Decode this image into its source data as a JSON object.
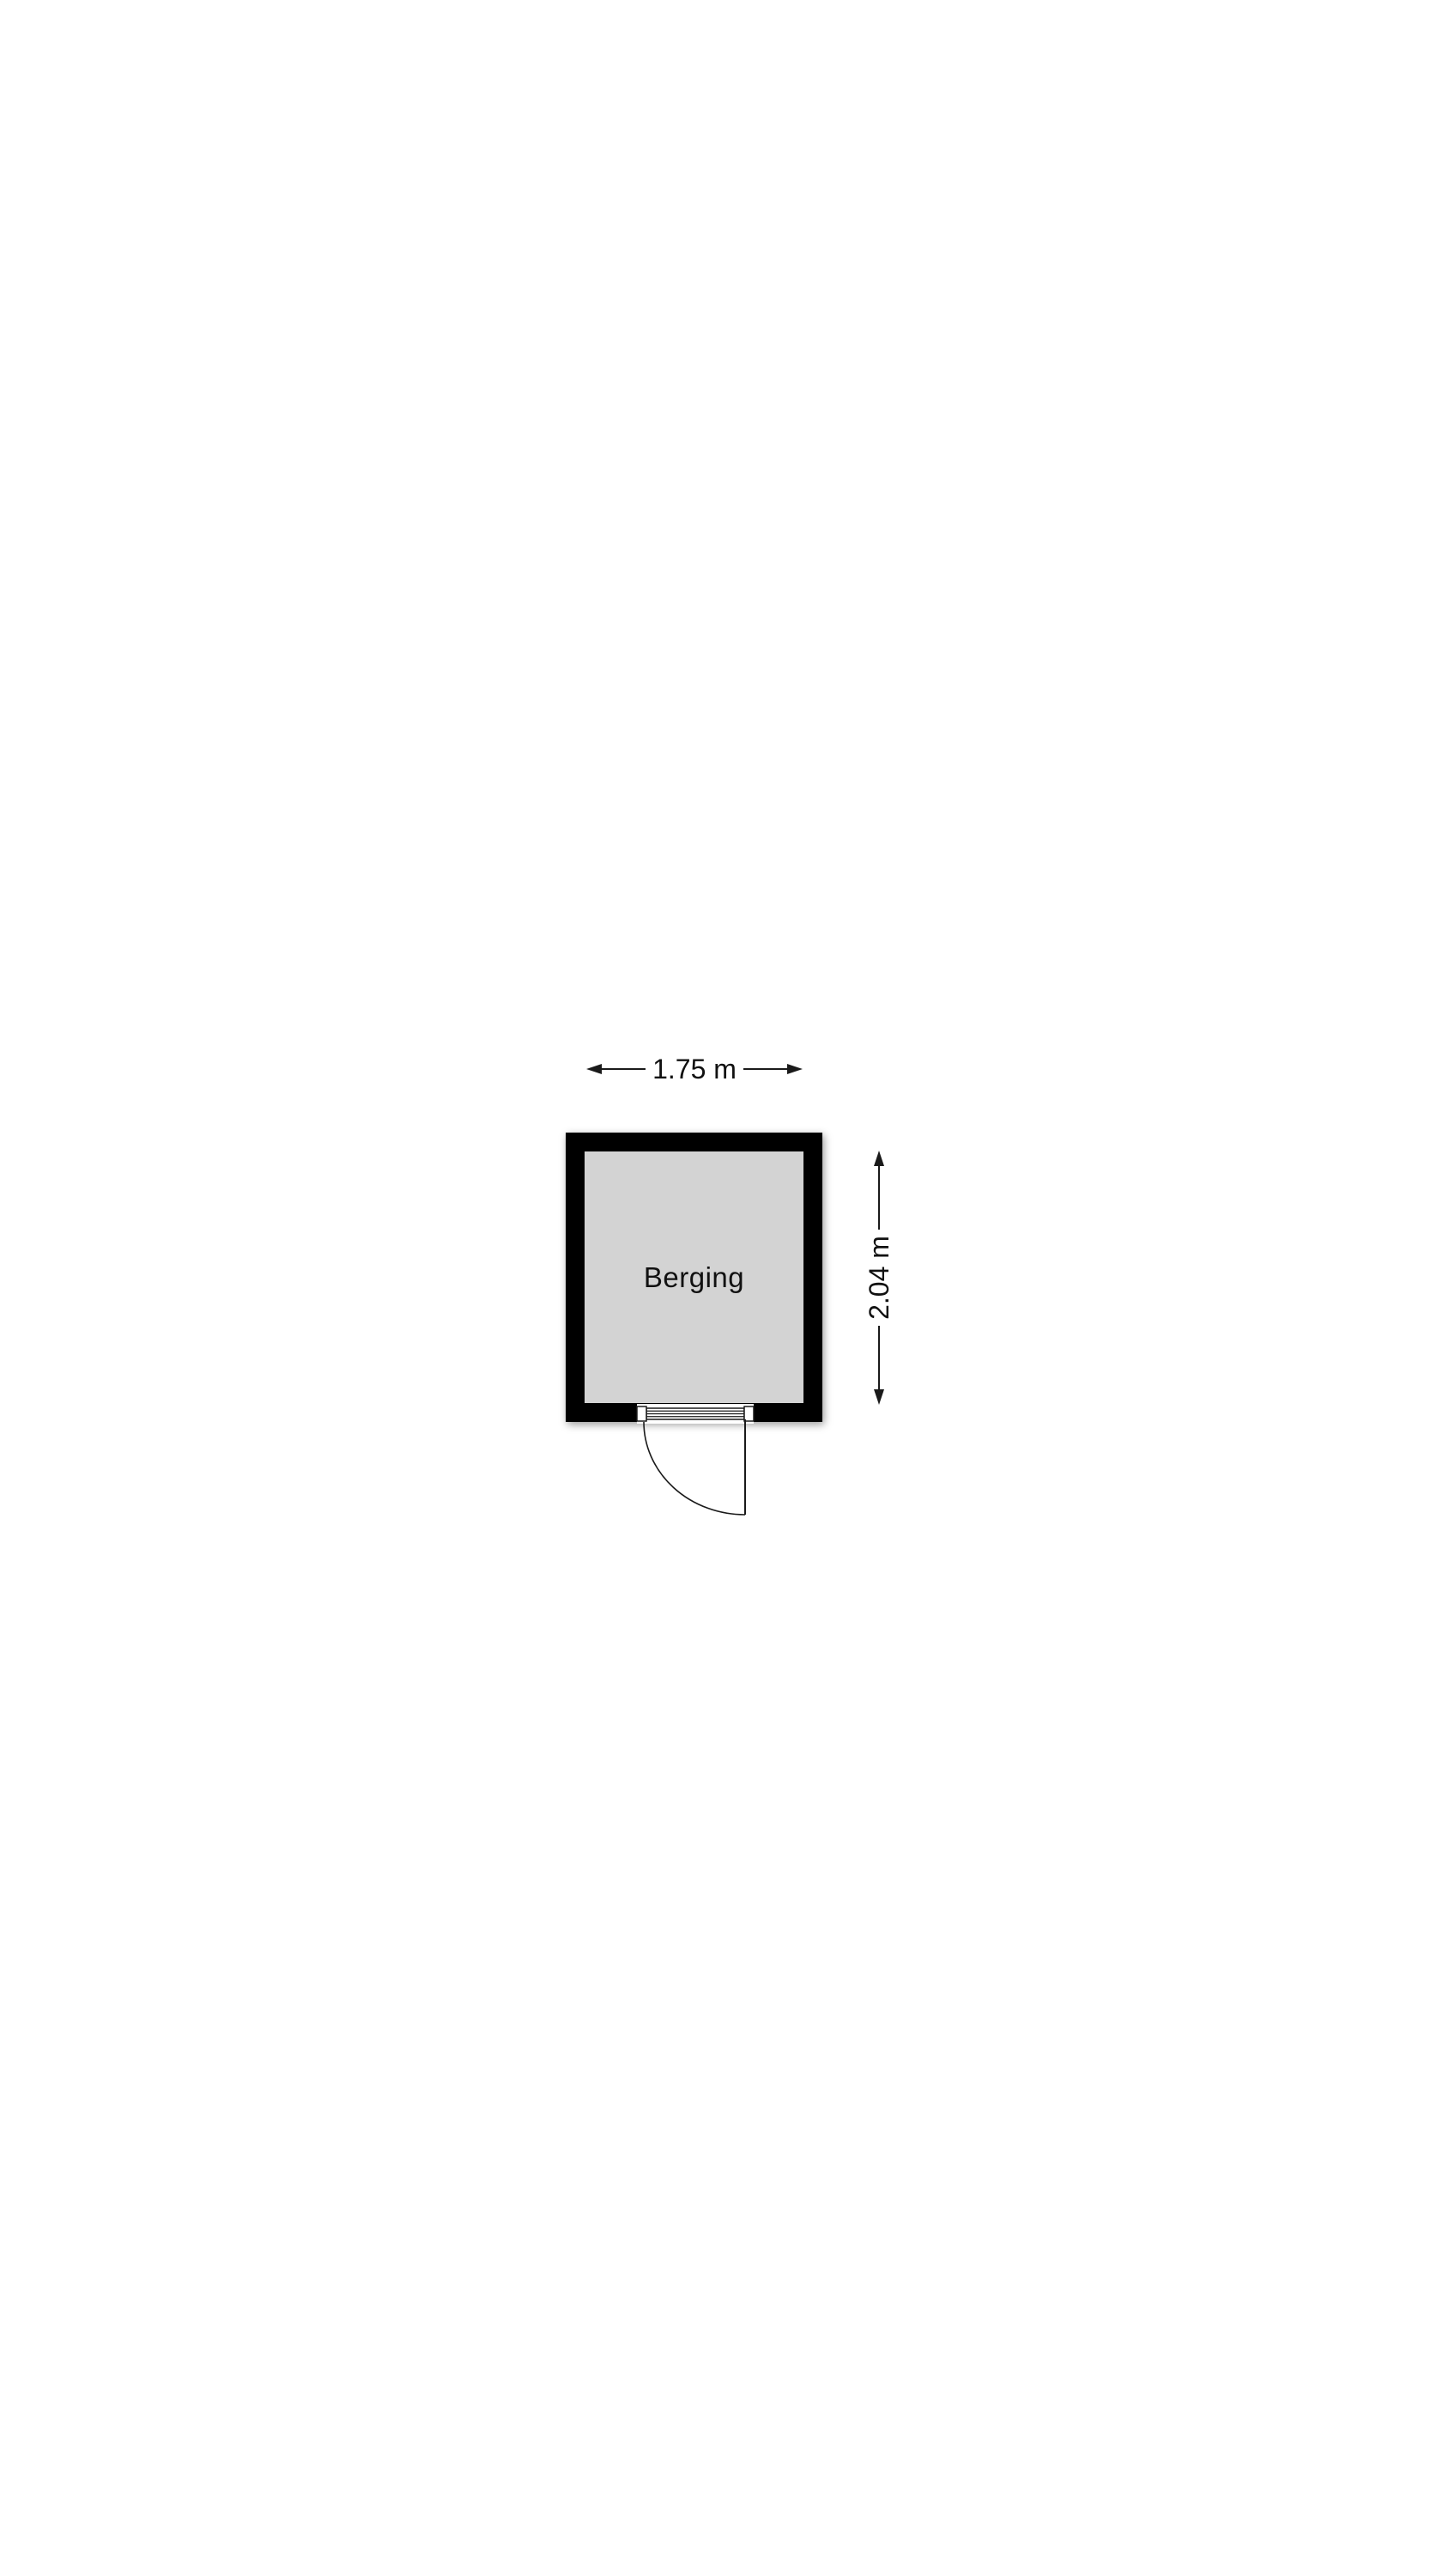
{
  "colors": {
    "background": "#ffffff",
    "wall": "#000000",
    "floor": "#d3d3d3",
    "line": "#1a1a1a",
    "text": "#111111",
    "shadow": "rgba(0,0,0,0.40)"
  },
  "floor_plan": {
    "room": {
      "label": "Berging"
    },
    "dimensions": {
      "width": {
        "label": "1.75 m"
      },
      "height": {
        "label": "2.04 m"
      }
    },
    "door": {
      "symbol": "single-swing-door"
    }
  }
}
